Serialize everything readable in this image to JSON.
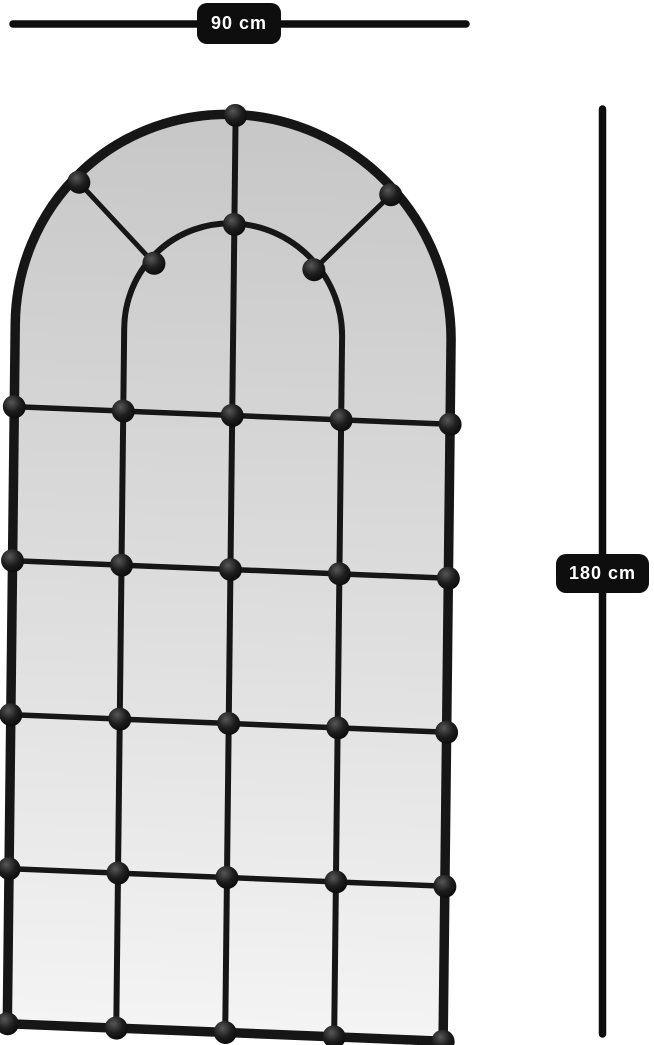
{
  "dimensions": {
    "width_label": "90 cm",
    "height_label": "180 cm"
  },
  "figure": {
    "subject": "arched-window-pane-mirror",
    "frame_color_name": "black",
    "grid_columns": 4,
    "pane_rows_below_arch": 4,
    "inner_fan_arch": true,
    "rivet_count": 31
  },
  "colors": {
    "background": "#ffffff",
    "frame": "#161616",
    "dimension": "#0e0e0e",
    "label_text": "#ffffff",
    "glass_top": "#c7c7c7",
    "glass_mid": "#dedede",
    "glass_bottom": "#f4f4f4"
  }
}
